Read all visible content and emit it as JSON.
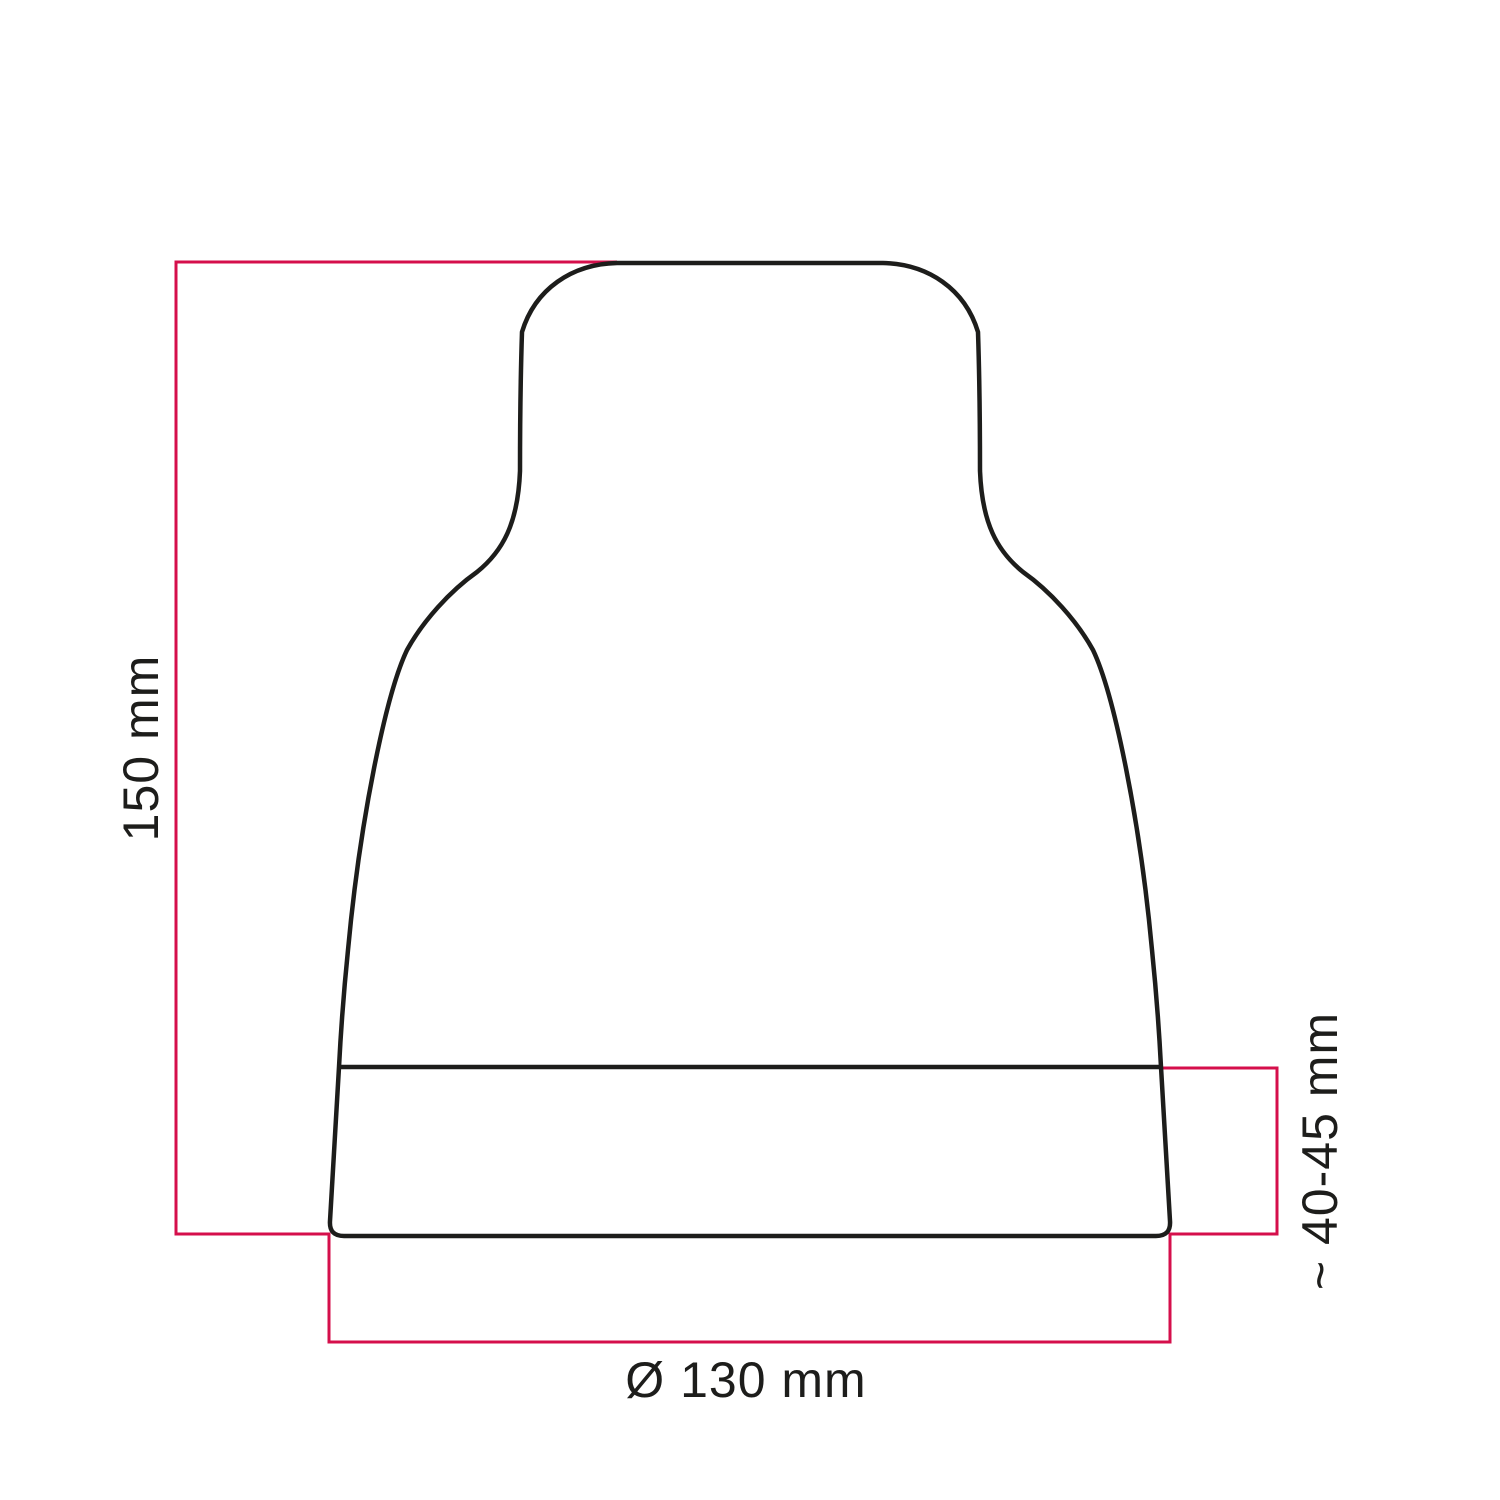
{
  "labels": {
    "height": "150 mm",
    "band_height": "~ 40-45 mm",
    "diameter": "Ø 130 mm"
  },
  "colors": {
    "outline": "#1d1d1b",
    "dimension_line": "#d50f4b",
    "text": "#1d1d1b",
    "background": "#ffffff"
  }
}
